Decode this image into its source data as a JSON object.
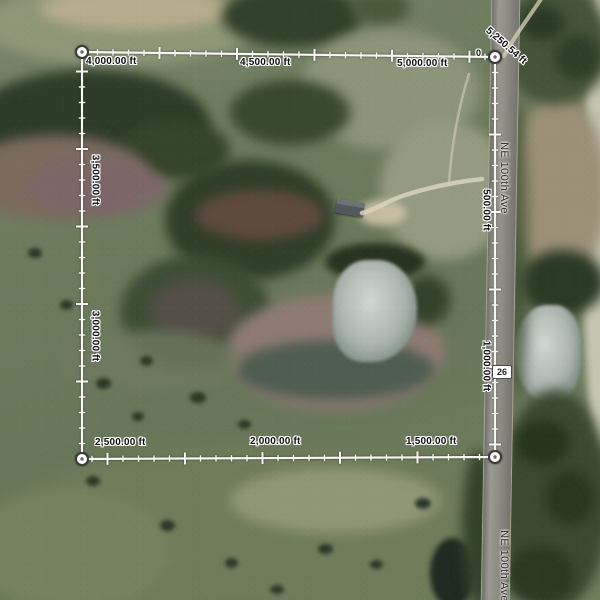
{
  "measurement": {
    "origin_label": "0",
    "total_label": "5,250.54 ft",
    "unit": "ft",
    "top_labels": [
      "4,000.00 ft",
      "4,500.00 ft",
      "5,000.00 ft"
    ],
    "right_labels": [
      "500.00 ft",
      "1,000.00 ft"
    ],
    "bottom_labels": [
      "2,500.00 ft",
      "2,000.00 ft",
      "1,500.00 ft"
    ],
    "left_labels": [
      "3,500.00 ft",
      "3,000.00 ft"
    ],
    "line_color": "#f7f7f3",
    "label_text_color": "#0e0e0e",
    "label_halo_color": "#ffffff"
  },
  "roads": {
    "labels": [
      "NE 100th Ave",
      "NE 100th Ave"
    ],
    "route_badge": "26",
    "badge_background": "#ffffff",
    "badge_border": "#4a4a4a",
    "badge_text_color": "#1f1f1f"
  }
}
